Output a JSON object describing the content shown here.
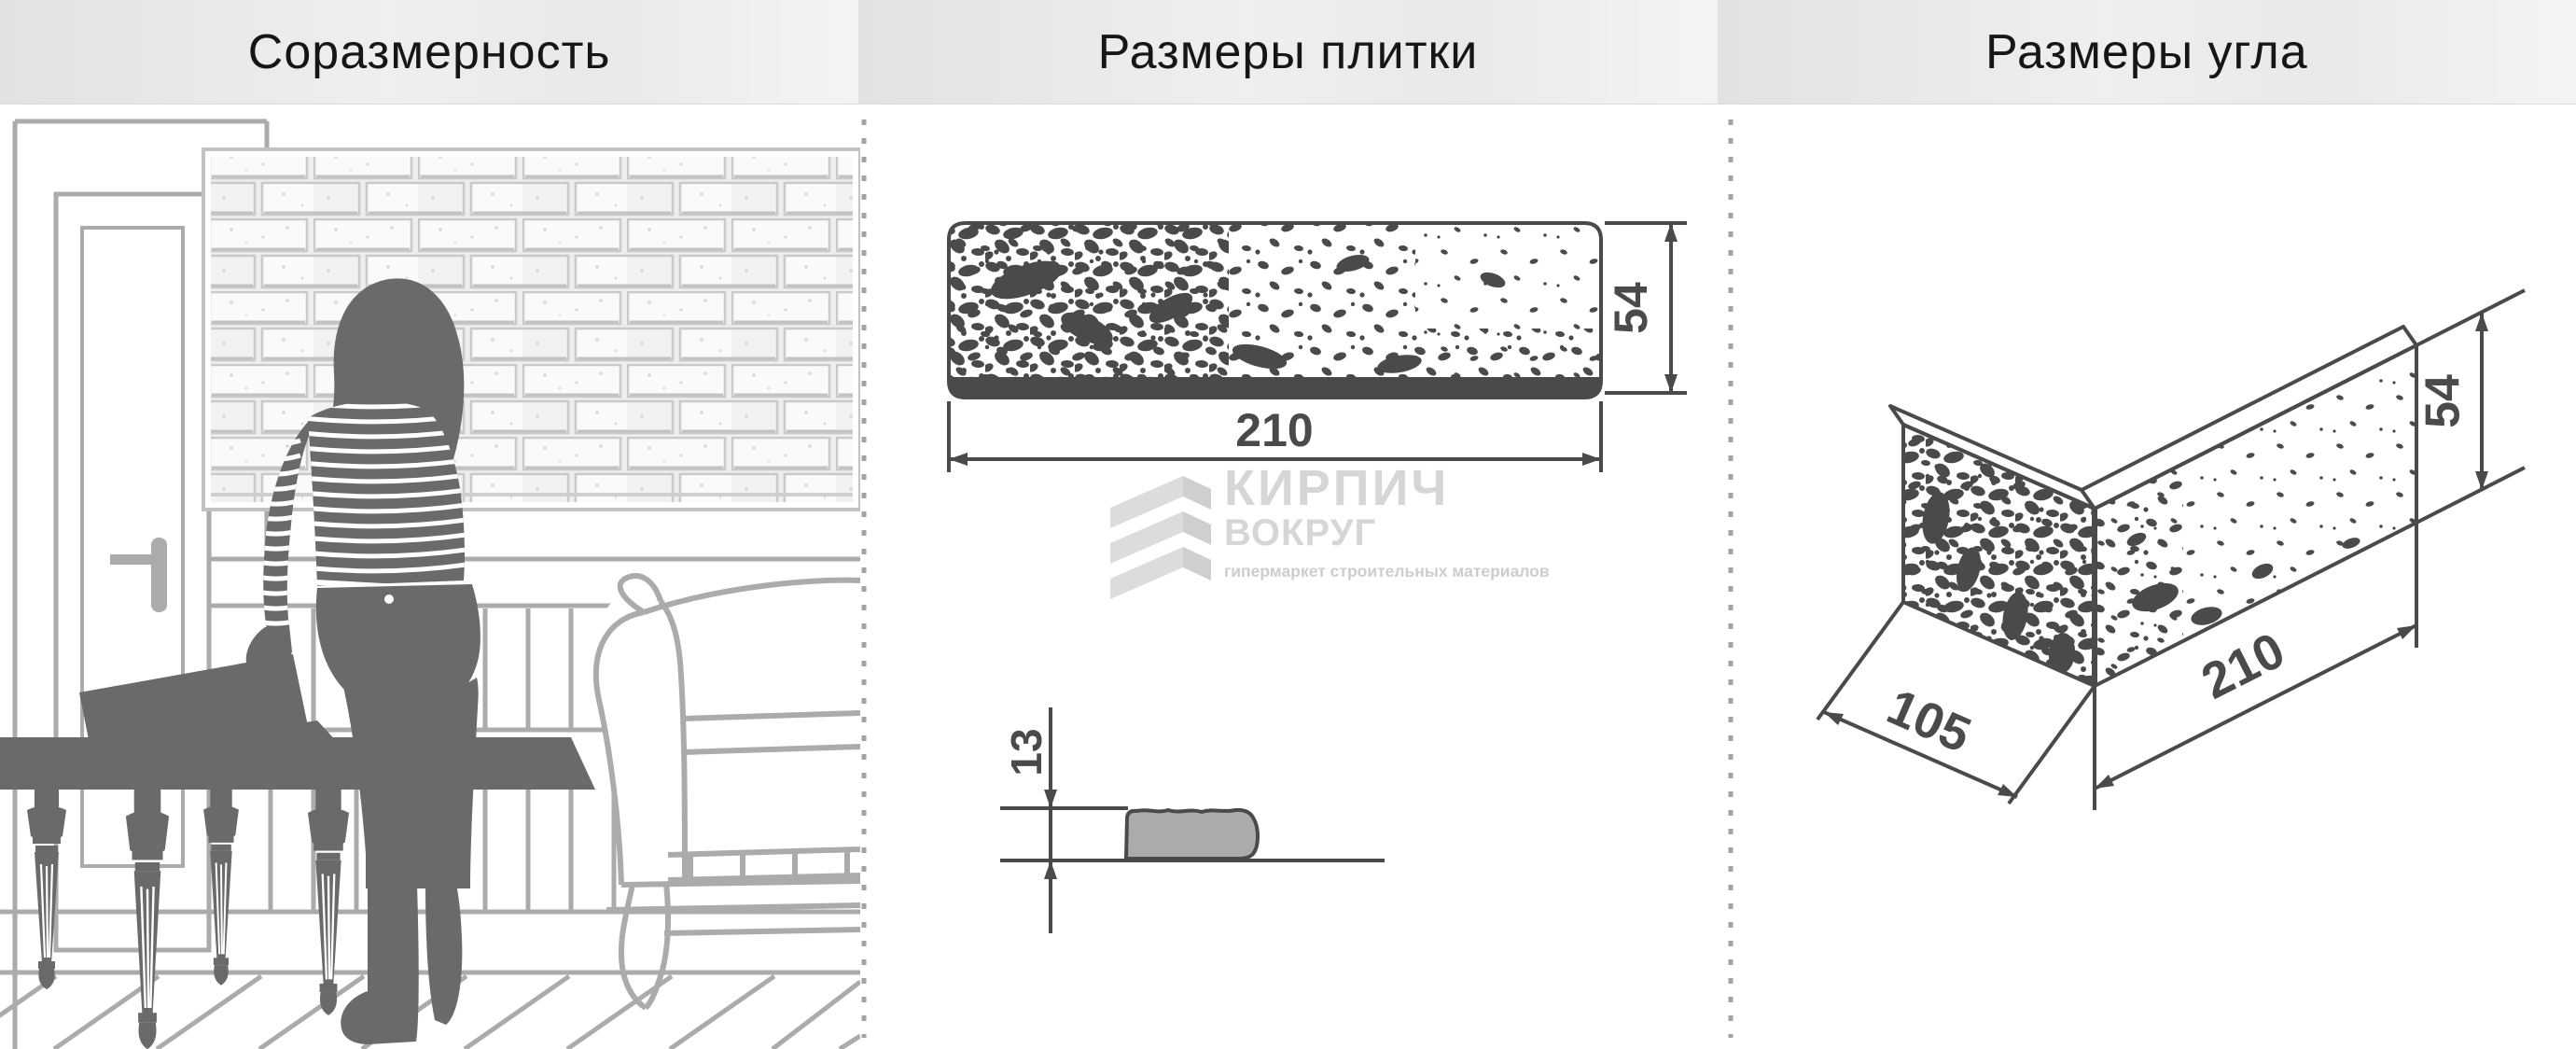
{
  "header": {
    "panels": [
      {
        "title": "Соразмерность"
      },
      {
        "title": "Размеры плитки"
      },
      {
        "title": "Размеры угла"
      }
    ]
  },
  "tile": {
    "width_mm": "210",
    "height_mm": "54",
    "thickness_mm": "13"
  },
  "corner": {
    "depth_mm": "105",
    "length_mm": "210",
    "height_mm": "54"
  },
  "logo": {
    "line1": "КИРПИЧ",
    "line2": "ВОКРУГ",
    "tagline": "гипермаркет строительных материалов"
  },
  "icons": {
    "logo_mark": "kirpich-vokrug-brick-zigzag"
  },
  "colors": {
    "ink": "#4a4a4a",
    "silhouette": "#6a6a6c",
    "furniture_line": "#ababab",
    "brick_line": "#c9c9c9",
    "logo_gray": "#d6d6d6",
    "header_bg": "#e9e9e9",
    "separator_dots": "#a3a3a3",
    "section_fill": "#ababab"
  }
}
